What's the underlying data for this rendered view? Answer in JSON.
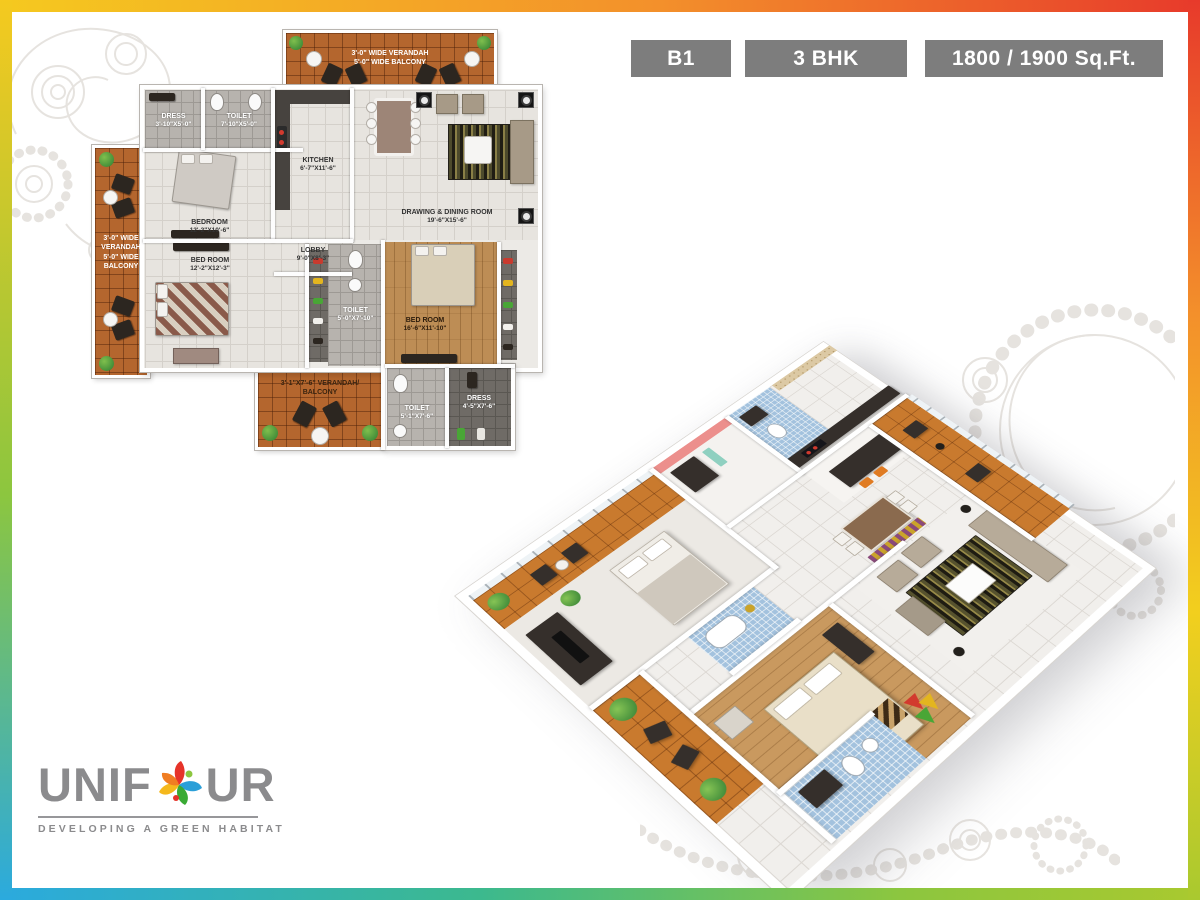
{
  "frame": {
    "gradient_top": [
      "#f5c91f",
      "#f3902b",
      "#e73a2b"
    ],
    "gradient_right": [
      "#e73a2b",
      "#f3902b",
      "#f2cf1e",
      "#a9c92f"
    ],
    "gradient_bottom": [
      "#2baade",
      "#3cb98e",
      "#8cc63f",
      "#a9c92f"
    ],
    "gradient_left": [
      "#f5c91f",
      "#8cc63f",
      "#2baade"
    ]
  },
  "header": {
    "badge_bg": "#7d7d7d",
    "badges": [
      {
        "label": "B1"
      },
      {
        "label": "3 BHK"
      },
      {
        "label": "1800 / 1900 Sq.Ft."
      }
    ]
  },
  "plan2d": {
    "verandah_top": {
      "line1": "3'-0\" WIDE VERANDAH",
      "line2": "5'-0\" WIDE BALCONY"
    },
    "verandah_left": {
      "line1": "3'-0\" WIDE",
      "line2": "VERANDAH",
      "line3": "5'-0\" WIDE",
      "line4": "BALCONY"
    },
    "verandah_bottom": {
      "line1": "3'-1\"X7'-6\" VERANDAH/",
      "line2": "BALCONY"
    },
    "rooms": {
      "dress1": {
        "name": "DRESS",
        "dims": "3'-10\"X5'-0\""
      },
      "toilet1": {
        "name": "TOILET",
        "dims": "7'-10\"X5'-0\""
      },
      "kitchen": {
        "name": "KITCHEN",
        "dims": "6'-7\"X11'-6\""
      },
      "drawing_dining": {
        "name": "DRAWING & DINING ROOM",
        "dims": "19'-6\"X15'-6\""
      },
      "bedroom1": {
        "name": "BEDROOM",
        "dims": "12'-2\"X10'-6\""
      },
      "lobby": {
        "name": "LOBBY",
        "dims": "9'-0\"X8'-3\""
      },
      "bedroom2": {
        "name": "BED ROOM",
        "dims": "12'-2\"X12'-3\""
      },
      "toilet2": {
        "name": "TOILET",
        "dims": "5'-0\"X7'-10\""
      },
      "bedroom3": {
        "name": "BED ROOM",
        "dims": "16'-6\"X11'-10\""
      },
      "toilet3": {
        "name": "TOILET",
        "dims": "5'-1\"X7'-6\""
      },
      "dress2": {
        "name": "DRESS",
        "dims": "4'-5\"X7'-6\""
      }
    }
  },
  "logo": {
    "word_start": "UNIF",
    "word_end": "UR",
    "tagline": "DEVELOPING A GREEN HABITAT",
    "text_color": "#8b8b8d",
    "petal_colors": [
      "#e63329",
      "#2b9fd8",
      "#3aaa35",
      "#f5b81c",
      "#f07d22"
    ]
  }
}
